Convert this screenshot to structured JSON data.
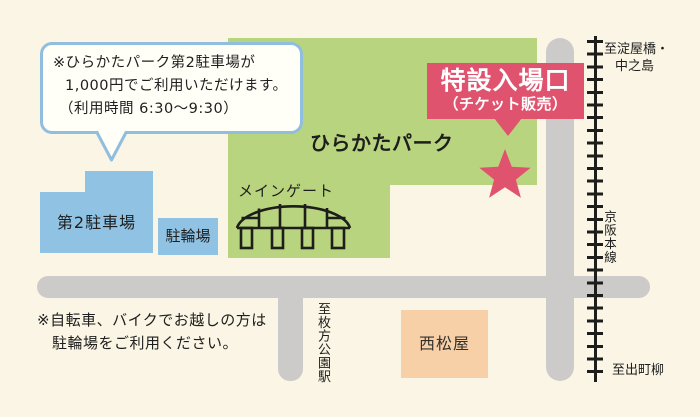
{
  "colors": {
    "background": "#FAF5E4",
    "park_green": "#B9D47F",
    "parking_blue": "#8FC2E3",
    "accent_red": "#E0536E",
    "road_gray": "#CCCBC9",
    "store_peach": "#F7D0A8",
    "bubble_border_blue": "#8FBEDE"
  },
  "park": {
    "name": "ひらかたパーク"
  },
  "entrance_badge": {
    "title": "特設入場口",
    "subtitle": "（チケット販売）"
  },
  "main_gate": {
    "label": "メインゲート"
  },
  "parking_note_bubble": {
    "line1": "※ひらかたパーク第2駐車場が",
    "line2": "1,000円でご利用いただけます。",
    "line3": "（利用時間 6:30～9:30）"
  },
  "parking_lot2": {
    "label": "第2駐車場"
  },
  "bicycle_parking": {
    "label": "駐輪場"
  },
  "store": {
    "name": "西松屋"
  },
  "railway": {
    "name": "京阪本線",
    "direction_north_line1": "至淀屋橋・",
    "direction_north_line2": "中之島",
    "direction_south": "至出町柳"
  },
  "station_direction": {
    "label": "至枚方公園駅"
  },
  "bicycle_note": {
    "line1": "※自転車、バイクでお越しの方は",
    "line2": "駐輪場をご利用ください。"
  }
}
